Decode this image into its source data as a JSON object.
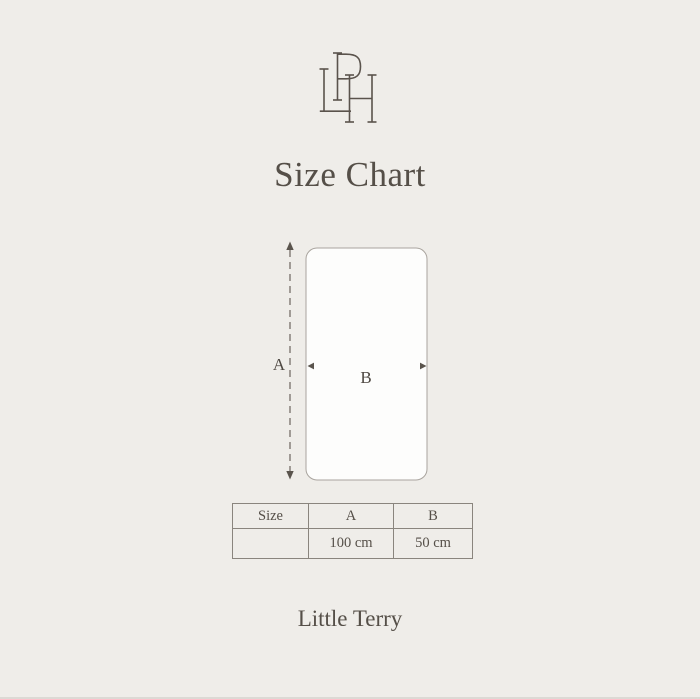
{
  "brand": {
    "monogram": "LPH",
    "name": "Little Terry"
  },
  "title": "Size Chart",
  "diagram": {
    "shape": "rounded-rectangle",
    "height_label": "A",
    "width_label": "B"
  },
  "size_table": {
    "headers": [
      "Size",
      "A",
      "B"
    ],
    "rows": [
      [
        "",
        "100 cm",
        "50 cm"
      ]
    ]
  },
  "colors": {
    "background": "#EFEDE9",
    "text": "#554F48",
    "table_border": "#8A857E",
    "rect_fill": "#FDFDFC",
    "rect_border": "#A9A49E",
    "arrow_line": "#6B655E"
  }
}
